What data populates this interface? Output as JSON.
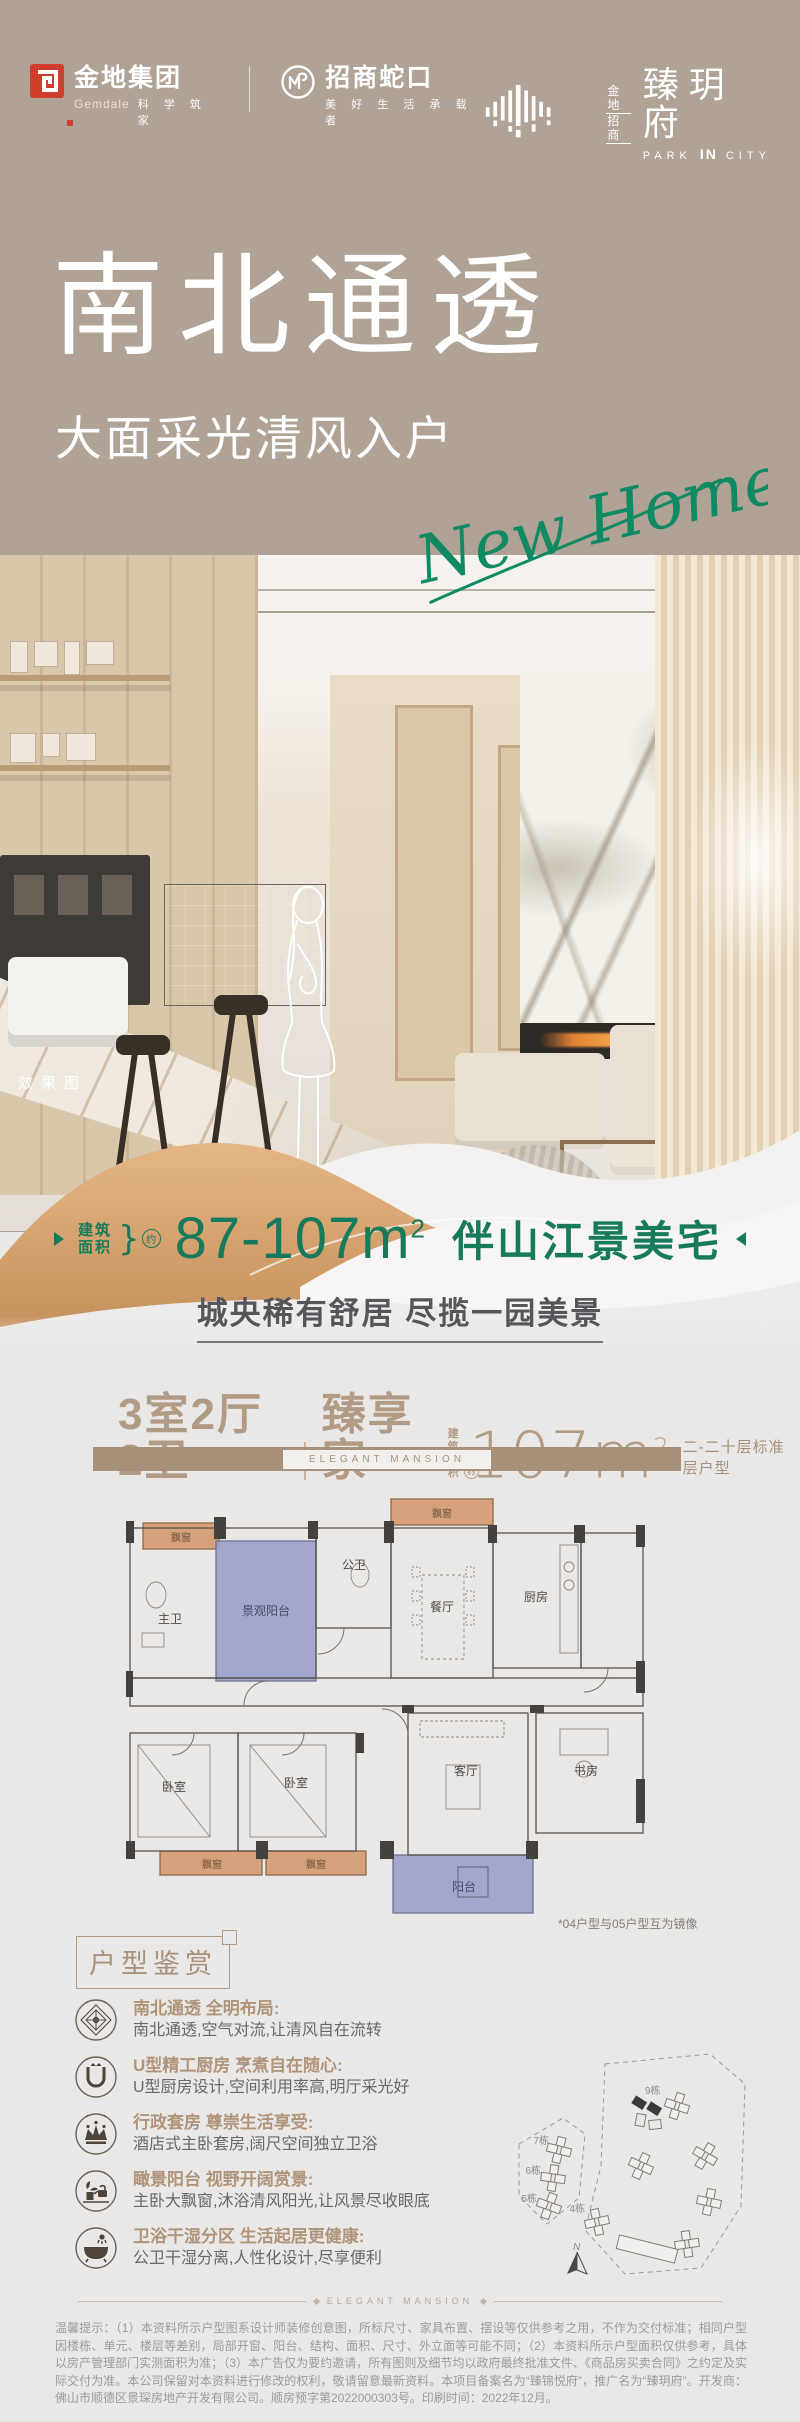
{
  "colors": {
    "taupe": "#b1a296",
    "accent_green": "#15805e",
    "tan": "#a8917b",
    "gold_dune": "#d3a06c",
    "brand_red": "#cf3e2d",
    "balcony_purple": "#9ba0c8",
    "bay_orange": "#d7a17b",
    "bg_gray": "#e9e8e6"
  },
  "brand": {
    "gemdale": {
      "cn": "金地集团",
      "en": "Gemdale",
      "tagline": "科 学 筑 家"
    },
    "cmsk": {
      "cn": "招商蛇口",
      "tagline": "美 好 生 活 承 载 者"
    },
    "project": {
      "prefix_top": "金地",
      "prefix_bottom": "招商",
      "name": "臻玥府",
      "en_left": "PARK",
      "en_mid": "IN",
      "en_right": "CITY"
    }
  },
  "hero": {
    "title": "南北通透",
    "subtitle": "大面采光清风入户",
    "script_text": "New Home",
    "render_label": "效果图"
  },
  "spec": {
    "area_label_top": "建筑",
    "area_label_bottom": "面积",
    "approx": "约",
    "range": "87-107m",
    "sup": "2",
    "feature": "伴山江景美宅",
    "slogan": "城央稀有舒居 尽揽一园美景"
  },
  "plan": {
    "layout": "3室2厅2卫",
    "name": "臻享家",
    "area_label_top": "建筑",
    "area_label_bottom": "面积",
    "approx": "约",
    "area": "107m",
    "sup": "2",
    "floors_note": "二-二十层标准层户型",
    "band_text": "ELEGANT MANSION"
  },
  "floorplan": {
    "labels": {
      "bay_window": "飘窗",
      "master_bath": "主卫",
      "view_balcony": "景观阳台",
      "public_bath": "公卫",
      "dining": "餐厅",
      "kitchen": "厨房",
      "living": "客厅",
      "study": "书房",
      "bedroom": "卧室",
      "balcony": "阳台"
    },
    "mirror_note": "*04户型与05户型互为镜像"
  },
  "appreciation": {
    "title": "户型鉴赏",
    "items": [
      {
        "icon": "compass-icon",
        "title": "南北通透 全明布局:",
        "desc": "南北通透,空气对流,让清风自在流转"
      },
      {
        "icon": "kitchen-u-icon",
        "title": "U型精工厨房 烹煮自在随心:",
        "desc": "U型厨房设计,空间利用率高,明厅采光好"
      },
      {
        "icon": "crown-icon",
        "title": "行政套房 尊崇生活享受:",
        "desc": "酒店式主卧套房,阔尺空间独立卫浴"
      },
      {
        "icon": "balcony-plant-icon",
        "title": "瞰景阳台 视野开阔赏景:",
        "desc": "主卧大飘窗,沐浴清风阳光,让风景尽收眼底"
      },
      {
        "icon": "bathtub-icon",
        "title": "卫浴干湿分区 生活起居更健康:",
        "desc": "公卫干湿分离,人性化设计,尽享便利"
      }
    ]
  },
  "siteplan": {
    "b7": "7栋",
    "b6": "6栋",
    "b5": "5栋",
    "b4": "4栋",
    "b9": "9栋",
    "north": "N"
  },
  "footer": {
    "divider_text": "ELEGANT MANSION",
    "disclaimer": "温馨提示：（1）本资料所示户型图系设计师装修创意图，所标尺寸、家具布置、摆设等仅供参考之用，不作为交付标准；相同户型因楼栋、单元、楼层等差别，局部开窗、阳台、结构、面积、尺寸、外立面等可能不同；（2）本资料所示户型面积仅供参考，具体以房产管理部门实测面积为准；（3）本广告仅为要约邀请，所有图则及细节均以政府最终批准文件、《商品房买卖合同》之约定及实际交付为准。本公司保留对本资料进行修改的权利，敬请留意最新资料。本项目备案名为“臻锦悦府”，推广名为“臻玥府”。开发商：佛山市顺德区景琛房地产开发有限公司。顺房预字第2022000303号。印刷时间：2022年12月。"
  }
}
